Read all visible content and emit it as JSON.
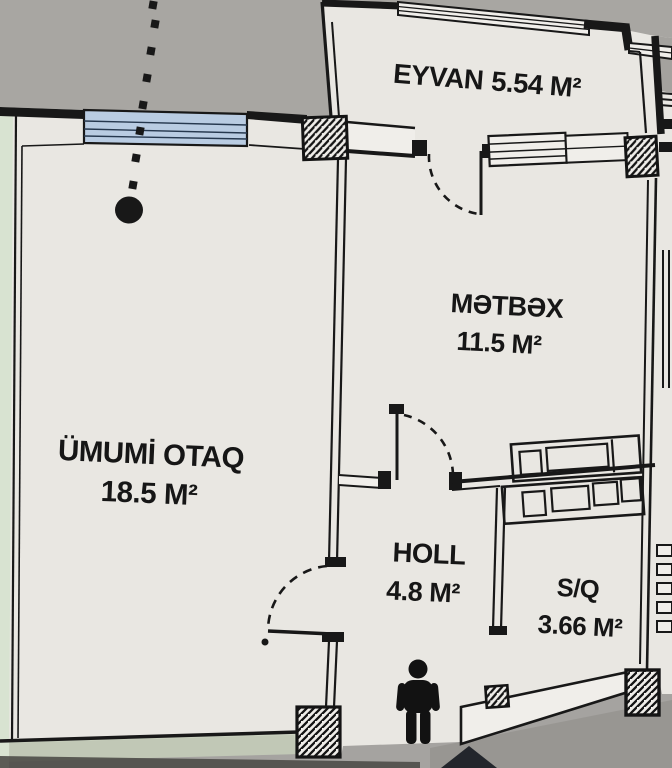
{
  "plan": {
    "rooms": {
      "eyvan": {
        "name": "EYVAN",
        "area": "5.54 M²"
      },
      "metbex": {
        "name": "MƏTBƏX",
        "area": "11.5 M²"
      },
      "umumi_otaq": {
        "name": "ÜMUMİ OTAQ",
        "area": "18.5 M²"
      },
      "holl": {
        "name": "HOLL",
        "area": "4.8 M²"
      },
      "sq": {
        "name": "S/Q",
        "area": "3.66 M²"
      }
    },
    "colors": {
      "wall": "#181818",
      "paper": "#e9e7e2",
      "outside": "#a8a6a2",
      "window_glass": "#b9cce2",
      "page_edge_green": "#d8e3d1",
      "bottom_band_green": "#c6cfba",
      "arrow": "#23262c"
    },
    "icons": {
      "person": "standing-person-icon",
      "entrance_arrow": "up-arrow-icon"
    }
  }
}
